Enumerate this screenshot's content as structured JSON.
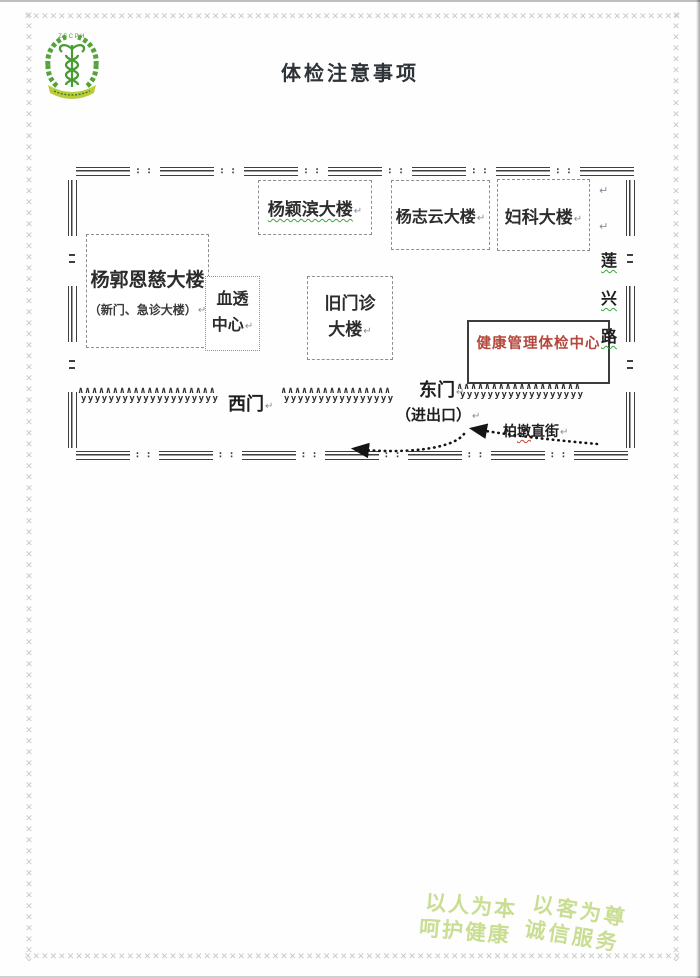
{
  "title": "体检注意事项",
  "logo": {
    "arc_text": "ZSCPH"
  },
  "map": {
    "buildings": {
      "yangyingbin": "杨颖滨大楼",
      "yangzhiyun": "杨志云大楼",
      "fuke": "妇科大楼",
      "yangguoenci": "杨郭恩慈大楼",
      "yangguoenci_sub": "（新门、急诊大楼）",
      "xuetou_1": "血透",
      "xuetou_2": "中心",
      "jiumenzhen_1": "旧门诊",
      "jiumenzhen_2": "大楼",
      "tijian": "健康管理体检中心"
    },
    "labels": {
      "west_gate": "西门",
      "east_gate": "东门",
      "east_gate_sub": "（进出口）",
      "street_c1": "柏",
      "street_c2": "墩",
      "street_c3": "直街",
      "road_c1": "莲",
      "road_c2": "兴",
      "road_c3": "路"
    },
    "colors": {
      "tijian_text": "#b5473c",
      "squiggle_green": "#3aa53a"
    }
  },
  "footer": {
    "s1": "以人为本",
    "s2": "呵护健康",
    "s3": "以客为尊",
    "s4": "诚信服务"
  },
  "marks": {
    "return": "↵"
  }
}
